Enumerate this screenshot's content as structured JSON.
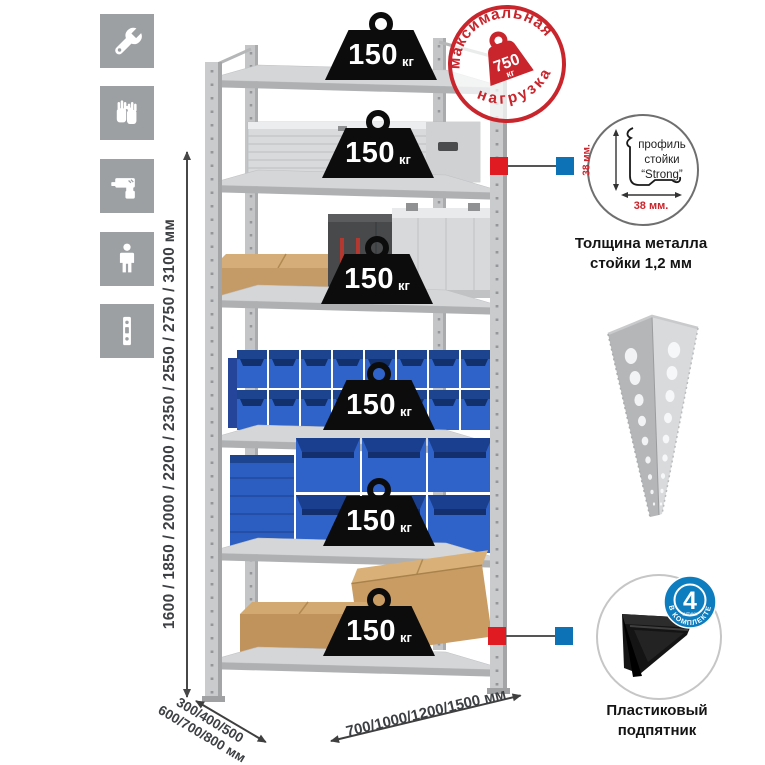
{
  "left_icons": {
    "bg_color": "#9ca0a3",
    "items": [
      "wrench-icon",
      "gloves-icon",
      "drill-icon",
      "person-icon",
      "rack-post-icon"
    ]
  },
  "height_dimension": {
    "label": "1600 / 1850 / 2000 / 2200 / 2350 / 2550 / 2750 / 3100 мм"
  },
  "depth_dimension": {
    "line1": "300/400/500",
    "line2": "600/700/800 мм"
  },
  "width_dimension": {
    "label": "700/1000/1200/1500 мм"
  },
  "shelf_load": {
    "value": "150",
    "unit": "кг",
    "shelf_count": 6
  },
  "max_load_stamp": {
    "arc_top": "максимальная",
    "arc_bottom": "нагрузка",
    "value": "750",
    "unit": "кг",
    "color": "#c9252c"
  },
  "profile_detail": {
    "text_line1": "профиль",
    "text_line2": "стойки",
    "text_line3": "“Strong”",
    "dim_side": "38 мм.",
    "dim_bottom": "38 мм.",
    "caption_line1": "Толщина металла",
    "caption_line2": "стойки 1,2 мм"
  },
  "foot_detail": {
    "badge_value": "4",
    "badge_sub": "штуки",
    "badge_arc": "в комплекте",
    "caption_line1": "Пластиковый",
    "caption_line2": "подпятник"
  },
  "colors": {
    "connector_red": "#e01b22",
    "connector_blue": "#0e72b7",
    "bin_blue": "#2f63c9",
    "cardboard": "#c49a66",
    "metal_light": "#d4d6d8"
  }
}
